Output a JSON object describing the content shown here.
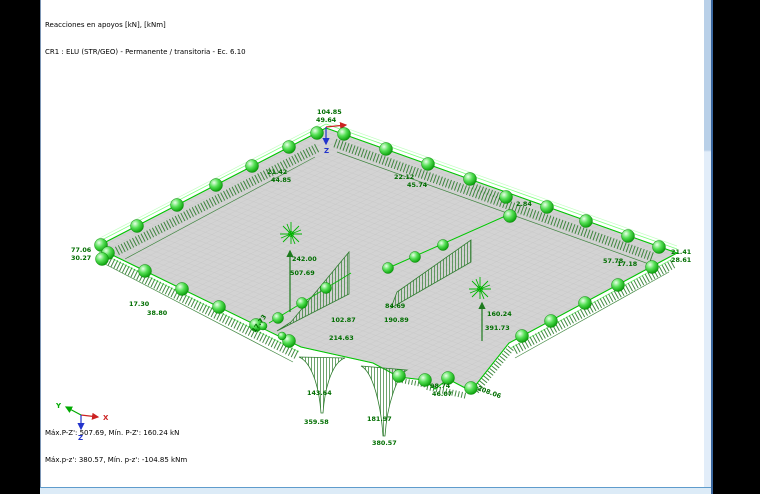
{
  "header": {
    "line1": "Reacciones en apoyos [kN], [kNm]",
    "line2": "CR1 : ELU (STR/GEO) - Permanente / transitoria - Ec. 6.10"
  },
  "footer": {
    "line1": "Máx.P-Z': 507.69, Mín. P-Z': 160.24 kN",
    "line2": "Máx.p-z': 380.57, Mín. p-z': -104.85 kNm"
  },
  "axes_triad": {
    "x_label": "X",
    "y_label": "Y",
    "z_label": "Z"
  },
  "top_node": {
    "axis_label": "Z"
  },
  "colors": {
    "support_green": "#00c800",
    "reaction_dark_green": "#2f7d2f",
    "label_green": "#006e00",
    "axis_x_red": "#cc2222",
    "axis_y_green": "#00aa00",
    "axis_z_blue": "#2233cc",
    "slab_gray": "#d3d3d3",
    "scrollbar_blue": "#dcebf7"
  },
  "reaction_labels": [
    {
      "text": "104.85",
      "x": 316,
      "y": 114
    },
    {
      "text": "49.64",
      "x": 315,
      "y": 122
    },
    {
      "text": "21.42",
      "x": 266,
      "y": 174
    },
    {
      "text": "44.85",
      "x": 270,
      "y": 182
    },
    {
      "text": "22.12",
      "x": 393,
      "y": 179
    },
    {
      "text": "45.74",
      "x": 406,
      "y": 187
    },
    {
      "text": "2.84",
      "x": 515,
      "y": 206
    },
    {
      "text": "77.06",
      "x": 70,
      "y": 252
    },
    {
      "text": "30.27",
      "x": 70,
      "y": 260
    },
    {
      "text": "17.30",
      "x": 128,
      "y": 306
    },
    {
      "text": "38.80",
      "x": 146,
      "y": 315
    },
    {
      "text": "242.00",
      "x": 291,
      "y": 261
    },
    {
      "text": "507.69",
      "x": 289,
      "y": 275
    },
    {
      "text": "17.73",
      "x": 254,
      "y": 333,
      "rot": -55
    },
    {
      "text": "102.87",
      "x": 330,
      "y": 322
    },
    {
      "text": "214.63",
      "x": 328,
      "y": 340
    },
    {
      "text": "84.69",
      "x": 384,
      "y": 308
    },
    {
      "text": "190.89",
      "x": 383,
      "y": 322
    },
    {
      "text": "160.24",
      "x": 486,
      "y": 316
    },
    {
      "text": "391.73",
      "x": 484,
      "y": 330
    },
    {
      "text": "57.78",
      "x": 602,
      "y": 263
    },
    {
      "text": "17.18",
      "x": 616,
      "y": 266
    },
    {
      "text": "21.41",
      "x": 670,
      "y": 254
    },
    {
      "text": "28.61",
      "x": 670,
      "y": 262
    },
    {
      "text": "98.74",
      "x": 429,
      "y": 388
    },
    {
      "text": "46.07",
      "x": 431,
      "y": 396
    },
    {
      "text": "208.06",
      "x": 476,
      "y": 390,
      "rot": 20
    },
    {
      "text": "143.64",
      "x": 306,
      "y": 395
    },
    {
      "text": "359.58",
      "x": 303,
      "y": 424
    },
    {
      "text": "181.97",
      "x": 366,
      "y": 421
    },
    {
      "text": "380.57",
      "x": 371,
      "y": 445
    }
  ]
}
